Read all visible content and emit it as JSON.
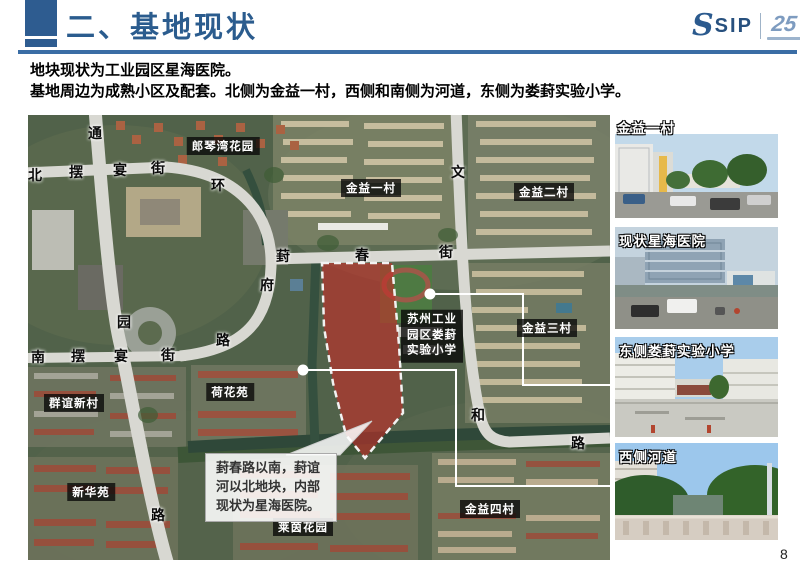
{
  "header": {
    "title": "二、基地现状"
  },
  "logo": {
    "s": "S",
    "sip": "SIP",
    "anniversary": "25"
  },
  "intro": {
    "line1": "地块现状为工业园区星海医院。",
    "line2": "基地周边为成熟小区及配套。北侧为金益一村，西侧和南侧为河道，东侧为娄葑实验小学。"
  },
  "map": {
    "road_chars": [
      {
        "t": "通",
        "x": 67,
        "y": 18
      },
      {
        "t": "北",
        "x": 7,
        "y": 60
      },
      {
        "t": "摆",
        "x": 48,
        "y": 57
      },
      {
        "t": "宴",
        "x": 92,
        "y": 55
      },
      {
        "t": "街",
        "x": 130,
        "y": 53
      },
      {
        "t": "环",
        "x": 190,
        "y": 70
      },
      {
        "t": "文",
        "x": 430,
        "y": 57
      },
      {
        "t": "葑",
        "x": 255,
        "y": 141
      },
      {
        "t": "春",
        "x": 334,
        "y": 140
      },
      {
        "t": "街",
        "x": 418,
        "y": 137
      },
      {
        "t": "府",
        "x": 239,
        "y": 170
      },
      {
        "t": "园",
        "x": 96,
        "y": 207
      },
      {
        "t": "路",
        "x": 195,
        "y": 225
      },
      {
        "t": "南",
        "x": 10,
        "y": 242
      },
      {
        "t": "摆",
        "x": 50,
        "y": 241
      },
      {
        "t": "宴",
        "x": 93,
        "y": 241
      },
      {
        "t": "街",
        "x": 140,
        "y": 240
      },
      {
        "t": "和",
        "x": 450,
        "y": 300
      },
      {
        "t": "路",
        "x": 550,
        "y": 328
      },
      {
        "t": "路",
        "x": 130,
        "y": 400
      }
    ],
    "area_labels": [
      {
        "text": "郎琴湾花园",
        "x": 195,
        "y": 31
      },
      {
        "text": "金益一村",
        "x": 343,
        "y": 73
      },
      {
        "text": "金益二村",
        "x": 516,
        "y": 77
      },
      {
        "text": "金益三村",
        "x": 519,
        "y": 213
      },
      {
        "text": "群谊新村",
        "x": 46,
        "y": 288
      },
      {
        "text": "荷花苑",
        "x": 202,
        "y": 277
      },
      {
        "text": "新华苑",
        "x": 63,
        "y": 377
      },
      {
        "text": "金益四村",
        "x": 462,
        "y": 394
      },
      {
        "text": "莱茵花园",
        "x": 275,
        "y": 412
      }
    ],
    "school_label": [
      "苏州工业",
      "园区娄葑",
      "实验小学"
    ],
    "callout": "葑春路以南，葑谊河以北地块，内部现状为星海医院。",
    "site_fill": "#c32d28",
    "leader_color": "#ffffff"
  },
  "photos": [
    {
      "caption": "金益一村"
    },
    {
      "caption": "现状星海医院"
    },
    {
      "caption": "东侧娄葑实验小学"
    },
    {
      "caption": "西侧河道"
    }
  ],
  "page_number": "8"
}
